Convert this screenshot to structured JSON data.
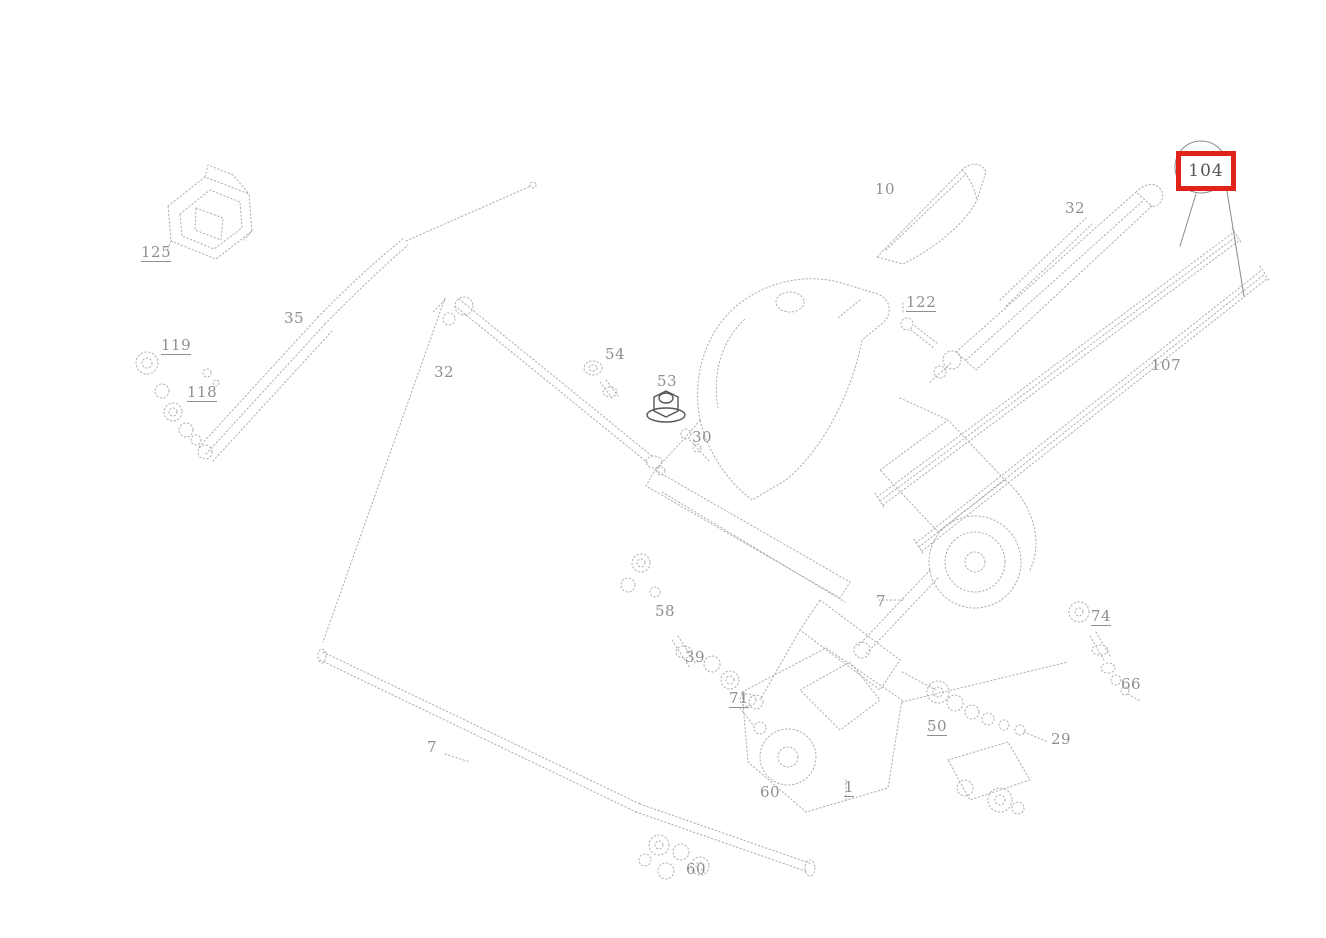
{
  "diagram": {
    "kind": "exploded-parts-diagram",
    "background_color": "#ffffff",
    "line_color": "#adadad",
    "label_color": "#8f8f8f",
    "highlight": {
      "part_number": "104",
      "box_color": "#e2231a",
      "x": 1176,
      "y": 151,
      "width": 50,
      "height": 30
    },
    "labels": [
      {
        "text": "125",
        "x": 141,
        "y": 245,
        "underlined": true
      },
      {
        "text": "119",
        "x": 161,
        "y": 338,
        "underlined": true
      },
      {
        "text": "118",
        "x": 187,
        "y": 385,
        "underlined": true
      },
      {
        "text": "35",
        "x": 284,
        "y": 311,
        "underlined": false
      },
      {
        "text": "32",
        "x": 434,
        "y": 365,
        "underlined": false
      },
      {
        "text": "54",
        "x": 605,
        "y": 347,
        "underlined": false
      },
      {
        "text": "53",
        "x": 657,
        "y": 374,
        "underlined": false
      },
      {
        "text": "30",
        "x": 692,
        "y": 430,
        "underlined": false
      },
      {
        "text": "10",
        "x": 875,
        "y": 182,
        "underlined": false
      },
      {
        "text": "122",
        "x": 906,
        "y": 295,
        "underlined": true
      },
      {
        "text": "32",
        "x": 1065,
        "y": 201,
        "underlined": false
      },
      {
        "text": "107",
        "x": 1151,
        "y": 358,
        "underlined": false
      },
      {
        "text": "74",
        "x": 1091,
        "y": 609,
        "underlined": true
      },
      {
        "text": "66",
        "x": 1121,
        "y": 677,
        "underlined": false
      },
      {
        "text": "7",
        "x": 876,
        "y": 594,
        "underlined": false
      },
      {
        "text": "58",
        "x": 655,
        "y": 604,
        "underlined": false
      },
      {
        "text": "39",
        "x": 685,
        "y": 650,
        "underlined": false
      },
      {
        "text": "71",
        "x": 729,
        "y": 691,
        "underlined": true
      },
      {
        "text": "50",
        "x": 927,
        "y": 719,
        "underlined": true
      },
      {
        "text": "29",
        "x": 1051,
        "y": 732,
        "underlined": false
      },
      {
        "text": "1",
        "x": 844,
        "y": 780,
        "underlined": true
      },
      {
        "text": "7",
        "x": 427,
        "y": 740,
        "underlined": false
      },
      {
        "text": "60",
        "x": 760,
        "y": 785,
        "underlined": false
      },
      {
        "text": "60",
        "x": 686,
        "y": 862,
        "underlined": false
      }
    ]
  }
}
